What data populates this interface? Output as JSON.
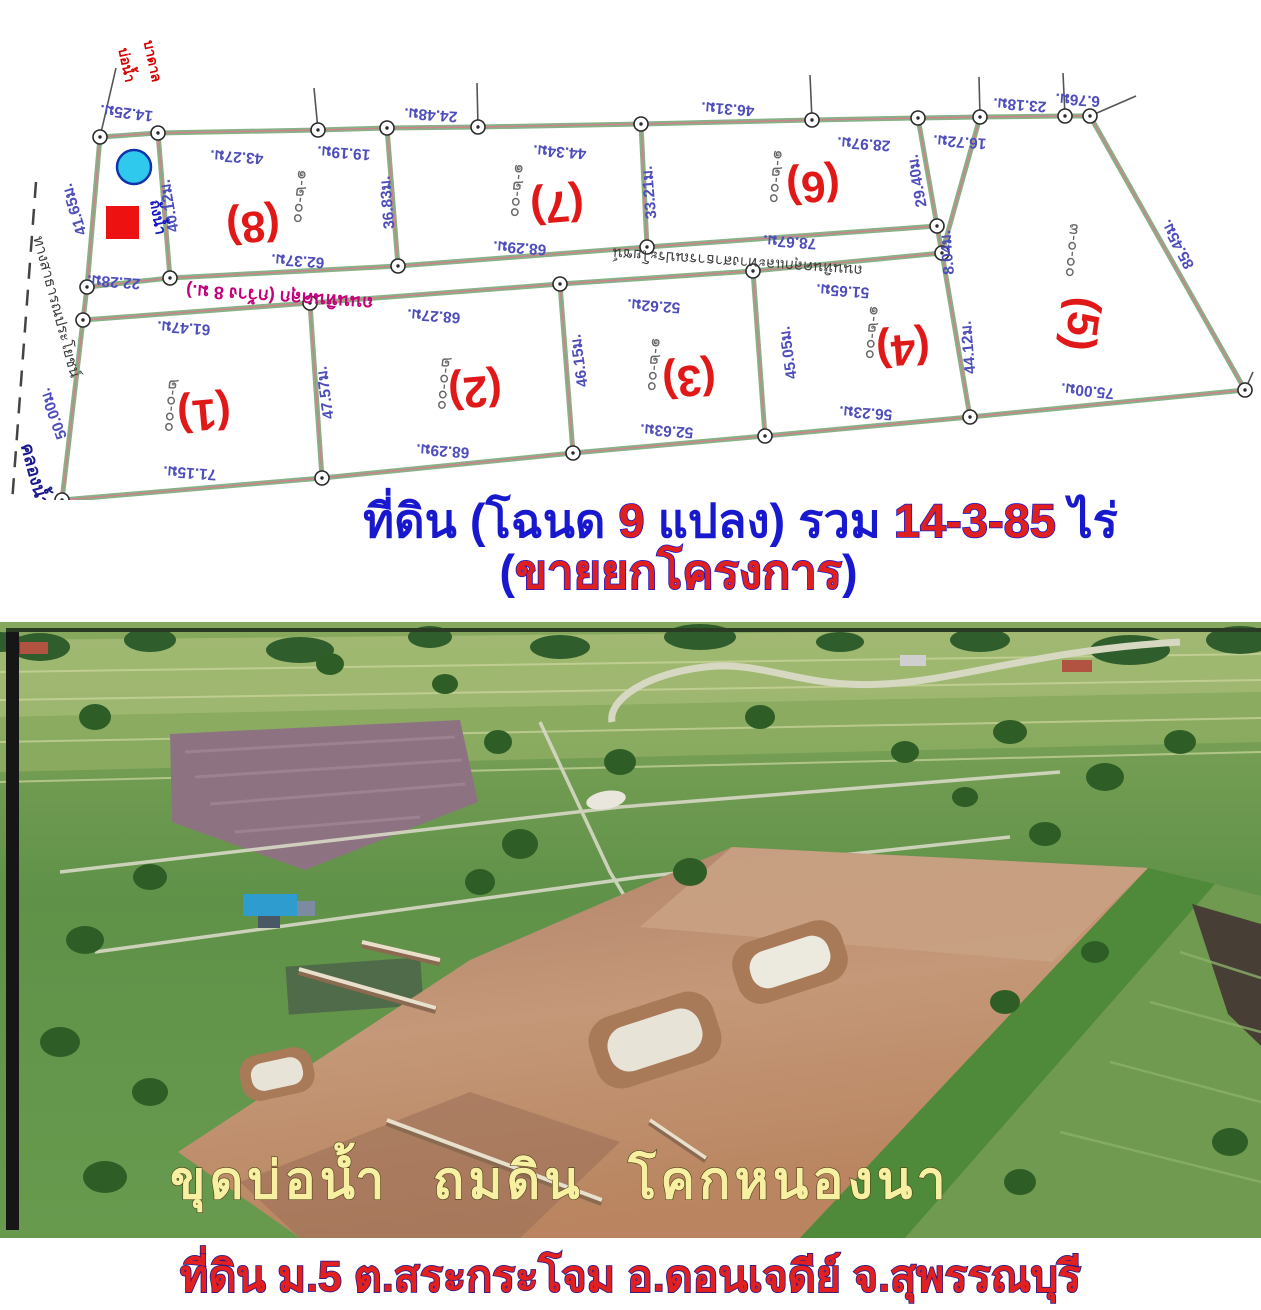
{
  "header": {
    "line1_parts": [
      {
        "text": "ที่ดิน (โฉนด ",
        "style": "blue"
      },
      {
        "text": "9",
        "style": "red"
      },
      {
        "text": " แปลง) รวม ",
        "style": "blue"
      },
      {
        "text": "14-3-85",
        "style": "red"
      },
      {
        "text": " ไร่",
        "style": "blue"
      }
    ],
    "line2_parts": [
      {
        "text": "(",
        "style": "blue"
      },
      {
        "text": "ขายยกโครงการ",
        "style": "red"
      },
      {
        "text": ")",
        "style": "blue"
      }
    ]
  },
  "photo": {
    "overlay_text": "ขุดบ่อน้ำ ถมดิน โคกหนองนา"
  },
  "footer": {
    "caption": "ที่ดิน ม.5 ต.สระกระโจม อ.ดอนเจดีย์ จ.สุพรรณบุรี"
  },
  "map": {
    "colors": {
      "boundary_green": "#86b286",
      "boundary_red": "#d27f8d",
      "measure": "#4d4dbb",
      "plot_no": "#e01818",
      "area_label": "#666666",
      "well_fill": "#2fc9ee",
      "well_stroke": "#1133aa",
      "tank_fill": "#ee1111"
    },
    "segments": [
      [
        100,
        137,
        158,
        133
      ],
      [
        158,
        133,
        318,
        130
      ],
      [
        318,
        130,
        387,
        128
      ],
      [
        387,
        128,
        478,
        127
      ],
      [
        478,
        127,
        641,
        124
      ],
      [
        641,
        124,
        812,
        120
      ],
      [
        812,
        120,
        918,
        118
      ],
      [
        918,
        118,
        980,
        117
      ],
      [
        980,
        117,
        1065,
        116
      ],
      [
        1065,
        116,
        1090,
        116
      ],
      [
        1090,
        116,
        1245,
        390
      ],
      [
        1245,
        390,
        970,
        417
      ],
      [
        970,
        417,
        942,
        253
      ],
      [
        942,
        253,
        937,
        226
      ],
      [
        937,
        226,
        918,
        118
      ],
      [
        980,
        117,
        942,
        253
      ],
      [
        100,
        137,
        87,
        287
      ],
      [
        87,
        287,
        83,
        320
      ],
      [
        83,
        320,
        62,
        500
      ],
      [
        158,
        133,
        170,
        278
      ],
      [
        87,
        287,
        170,
        278
      ],
      [
        170,
        278,
        398,
        266
      ],
      [
        398,
        266,
        647,
        247
      ],
      [
        647,
        247,
        937,
        226
      ],
      [
        83,
        320,
        310,
        303
      ],
      [
        310,
        303,
        560,
        284
      ],
      [
        560,
        284,
        753,
        271
      ],
      [
        753,
        271,
        942,
        253
      ],
      [
        387,
        128,
        398,
        266
      ],
      [
        641,
        124,
        647,
        247
      ],
      [
        310,
        303,
        322,
        478
      ],
      [
        560,
        284,
        573,
        453
      ],
      [
        753,
        271,
        765,
        436
      ],
      [
        62,
        500,
        322,
        478
      ],
      [
        322,
        478,
        573,
        453
      ],
      [
        573,
        453,
        765,
        436
      ],
      [
        765,
        436,
        970,
        417
      ]
    ],
    "vertices": [
      [
        100,
        137
      ],
      [
        158,
        133
      ],
      [
        318,
        130
      ],
      [
        387,
        128
      ],
      [
        478,
        127
      ],
      [
        641,
        124
      ],
      [
        812,
        120
      ],
      [
        918,
        118
      ],
      [
        980,
        117
      ],
      [
        1065,
        116
      ],
      [
        1090,
        116
      ],
      [
        1245,
        390
      ],
      [
        970,
        417
      ],
      [
        942,
        253
      ],
      [
        937,
        226
      ],
      [
        87,
        287
      ],
      [
        83,
        320
      ],
      [
        62,
        500
      ],
      [
        170,
        278
      ],
      [
        398,
        266
      ],
      [
        647,
        247
      ],
      [
        310,
        303
      ],
      [
        560,
        284
      ],
      [
        753,
        271
      ],
      [
        322,
        478
      ],
      [
        573,
        453
      ],
      [
        765,
        436
      ]
    ],
    "ticks": [
      [
        318,
        130,
        314,
        88
      ],
      [
        478,
        127,
        477,
        83
      ],
      [
        812,
        120,
        810,
        75
      ],
      [
        980,
        117,
        979,
        77
      ],
      [
        1065,
        116,
        1063,
        73
      ],
      [
        1090,
        116,
        1136,
        96
      ],
      [
        100,
        137,
        116,
        68
      ],
      [
        62,
        500,
        49,
        548
      ],
      [
        1245,
        390,
        1253,
        372
      ]
    ],
    "dashed": [
      [
        36,
        182,
        8,
        556
      ]
    ],
    "measurements": [
      {
        "t": "14.25ม.",
        "x": 127,
        "y": 108,
        "r": 187
      },
      {
        "t": "43.27ม.",
        "x": 237,
        "y": 152,
        "r": 184
      },
      {
        "t": "19.19ม.",
        "x": 344,
        "y": 148,
        "r": 184
      },
      {
        "t": "24.48ม.",
        "x": 431,
        "y": 110,
        "r": 184
      },
      {
        "t": "44.34ม.",
        "x": 560,
        "y": 147,
        "r": 184
      },
      {
        "t": "46.31ม.",
        "x": 728,
        "y": 104,
        "r": 184
      },
      {
        "t": "28.97ม.",
        "x": 864,
        "y": 139,
        "r": 184
      },
      {
        "t": "16.72ม.",
        "x": 960,
        "y": 137,
        "r": 184
      },
      {
        "t": "23.18ม.",
        "x": 1020,
        "y": 100,
        "r": 184
      },
      {
        "t": "6.76ม.",
        "x": 1078,
        "y": 95,
        "r": 184
      },
      {
        "t": "85.45ม.",
        "x": 1182,
        "y": 242,
        "r": 242
      },
      {
        "t": "75.00ม.",
        "x": 1088,
        "y": 386,
        "r": 186
      },
      {
        "t": "44.12ม.",
        "x": 973,
        "y": 347,
        "r": 265
      },
      {
        "t": "8.04ม.",
        "x": 952,
        "y": 252,
        "r": 265
      },
      {
        "t": "29.40ม.",
        "x": 922,
        "y": 180,
        "r": 260
      },
      {
        "t": "78.67ม.",
        "x": 790,
        "y": 237,
        "r": 184
      },
      {
        "t": "33.21ม.",
        "x": 654,
        "y": 192,
        "r": 265
      },
      {
        "t": "36.83ม.",
        "x": 392,
        "y": 202,
        "r": 265
      },
      {
        "t": "62.37ม.",
        "x": 298,
        "y": 256,
        "r": 184
      },
      {
        "t": "68.29ม.",
        "x": 520,
        "y": 243,
        "r": 184
      },
      {
        "t": "40.12ม.",
        "x": 174,
        "y": 205,
        "r": 260
      },
      {
        "t": "41.65ม.",
        "x": 79,
        "y": 208,
        "r": 253
      },
      {
        "t": "22.28ม.",
        "x": 114,
        "y": 277,
        "r": 184
      },
      {
        "t": "50.00ม.",
        "x": 58,
        "y": 412,
        "r": 250
      },
      {
        "t": "61.47ม.",
        "x": 184,
        "y": 323,
        "r": 184
      },
      {
        "t": "71.15ม.",
        "x": 190,
        "y": 468,
        "r": 184
      },
      {
        "t": "47.57ม.",
        "x": 330,
        "y": 392,
        "r": 262
      },
      {
        "t": "68.27ม.",
        "x": 434,
        "y": 311,
        "r": 184
      },
      {
        "t": "68.29ม.",
        "x": 443,
        "y": 446,
        "r": 184
      },
      {
        "t": "46.15ม.",
        "x": 584,
        "y": 360,
        "r": 262
      },
      {
        "t": "52.62ม.",
        "x": 654,
        "y": 301,
        "r": 184
      },
      {
        "t": "52.63ม.",
        "x": 667,
        "y": 426,
        "r": 184
      },
      {
        "t": "45.05ม.",
        "x": 793,
        "y": 352,
        "r": 262
      },
      {
        "t": "51.65ม.",
        "x": 843,
        "y": 286,
        "r": 184
      },
      {
        "t": "56.23ม.",
        "x": 866,
        "y": 408,
        "r": 184
      }
    ],
    "plots": [
      {
        "label": "(8)",
        "area": "๑-๒-๐๐",
        "nx": 252,
        "ny": 212,
        "nr": 175,
        "ax": 296,
        "ay": 196,
        "ar": 95
      },
      {
        "label": "(7)",
        "area": "๑-๒-๐๐",
        "nx": 556,
        "ny": 192,
        "nr": 175,
        "ax": 513,
        "ay": 190,
        "ar": 95
      },
      {
        "label": "(6)",
        "area": "๑-๒-๐๐",
        "nx": 812,
        "ny": 172,
        "nr": 175,
        "ax": 772,
        "ay": 176,
        "ar": 95
      },
      {
        "label": "(5)",
        "area": "๓-๐-๐๐",
        "nx": 1068,
        "ny": 322,
        "nr": 98,
        "ax": 1068,
        "ay": 250,
        "ar": 95
      },
      {
        "label": "(1)",
        "area": "๒-๐-๐๐",
        "nx": 203,
        "ny": 400,
        "nr": 175,
        "ax": 167,
        "ay": 405,
        "ar": 95
      },
      {
        "label": "(2)",
        "area": "๒-๐-๐๐",
        "nx": 474,
        "ny": 377,
        "nr": 175,
        "ax": 440,
        "ay": 383,
        "ar": 95
      },
      {
        "label": "(3)",
        "area": "๑-๒-๐๐",
        "nx": 688,
        "ny": 366,
        "nr": 175,
        "ax": 650,
        "ay": 364,
        "ar": 95
      },
      {
        "label": "(4)",
        "area": "๑-๒-๐๐",
        "nx": 902,
        "ny": 335,
        "nr": 175,
        "ax": 868,
        "ay": 332,
        "ar": 95
      }
    ],
    "labels": [
      {
        "t": "ถนนหินคลุก (กว้าง 8 ม.)",
        "x": 280,
        "y": 291,
        "r": 184,
        "c": "#c4007a",
        "fs": 18,
        "b": true
      },
      {
        "t": "ถนนหินคลุกและทางสาธารณประโยชน์",
        "x": 738,
        "y": 257,
        "r": 184,
        "c": "#3a3a3a",
        "fs": 15,
        "b": false
      },
      {
        "t": "ทางสาธารณประโยชน์",
        "x": 52,
        "y": 308,
        "r": 75,
        "c": "#3a3a3a",
        "fs": 15,
        "b": false
      },
      {
        "t": "คลองน้ำป่า",
        "x": 32,
        "y": 487,
        "r": 75,
        "c": "#1a1a8c",
        "fs": 18,
        "b": true
      },
      {
        "t": "บ่อน้ำ",
        "x": 122,
        "y": 66,
        "r": 78,
        "c": "#d40000",
        "fs": 14,
        "b": true
      },
      {
        "t": "บาดาล",
        "x": 148,
        "y": 62,
        "r": 78,
        "c": "#d40000",
        "fs": 14,
        "b": true
      },
      {
        "t": "ถังน้ำ",
        "x": 153,
        "y": 218,
        "r": 80,
        "c": "#1515c8",
        "fs": 15,
        "b": true
      }
    ],
    "well": {
      "cx": 134,
      "cy": 167,
      "r": 17
    },
    "tank": {
      "x": 106,
      "y": 206,
      "w": 33,
      "h": 33
    }
  }
}
